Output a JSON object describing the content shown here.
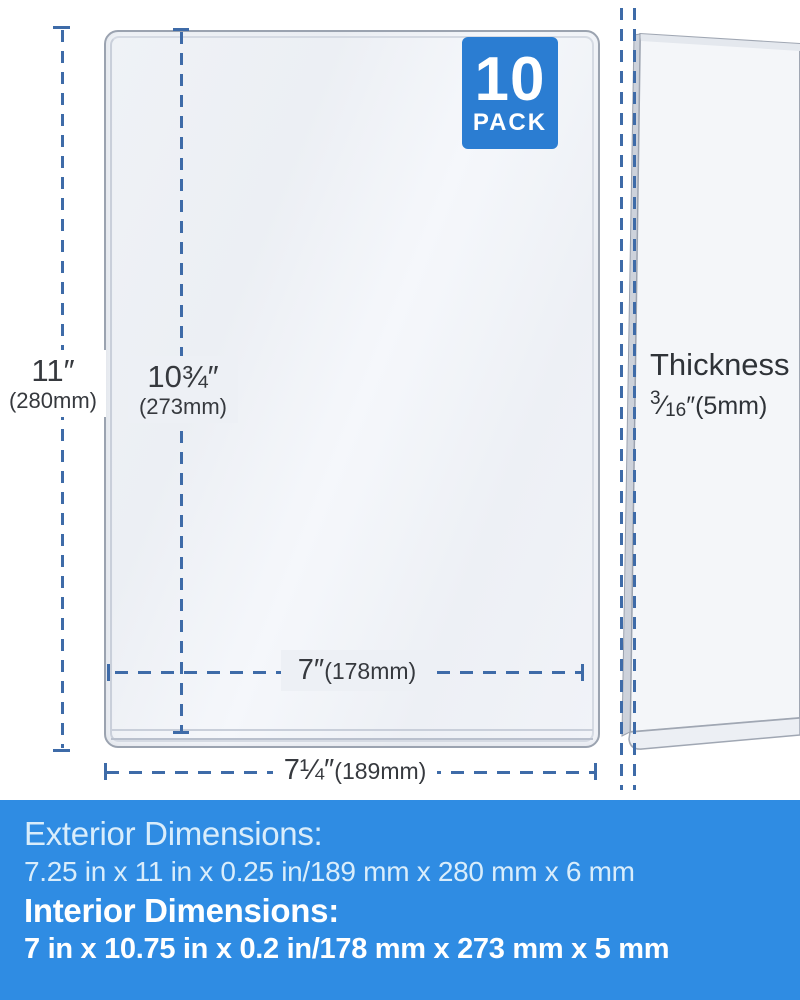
{
  "product": {
    "badge": {
      "count": "10",
      "label": "PACK"
    }
  },
  "annotations": {
    "exterior_height": {
      "value": "11″",
      "metric": "(280mm)"
    },
    "interior_height": {
      "value": "10¾″",
      "metric": "(273mm)"
    },
    "interior_width": {
      "value": "7″",
      "metric": "(178mm)"
    },
    "exterior_width": {
      "value": "7¼″",
      "metric": "(189mm)"
    },
    "thickness": {
      "label": "Thickness",
      "fraction_numerator": "3",
      "fraction_slash": "⁄",
      "fraction_denominator": "16",
      "suffix": "″(5mm)"
    }
  },
  "banner": {
    "exterior_title": "Exterior Dimensions:",
    "exterior_value": "7.25 in x 11 in x 0.25 in/189 mm x 280 mm x 6 mm",
    "interior_title": "Interior Dimensions:",
    "interior_value": "7 in x 10.75 in x 0.2 in/178 mm x 273 mm x 5 mm"
  },
  "colors": {
    "banner_blue": "#2f8ce3",
    "badge_blue": "#2b7dd2",
    "dimension_line_blue": "#3e6ba8",
    "label_text": "#36393e",
    "panel_fill": "#eff2f6",
    "panel_border": "#9ba3b0"
  }
}
